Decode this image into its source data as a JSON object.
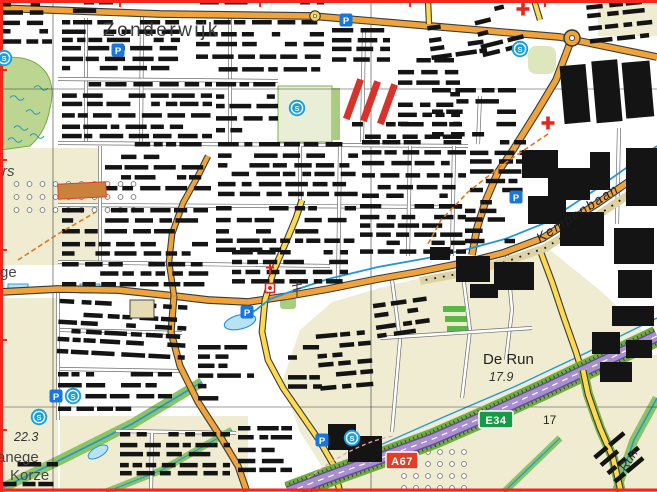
{
  "labels": {
    "town": "Zonderwijk",
    "street": "Kempenbaan",
    "area": "De Run",
    "area_elevation": "17.9",
    "elevation_sw": "22.3",
    "partial_left_top": "rs",
    "partial_left_mid": "ge",
    "partial_manege": "anege",
    "partial_korze": "Korze",
    "parcel": "17",
    "stream": "Run"
  },
  "shields": {
    "e_road": "E34",
    "a_road": "A67"
  },
  "icons": {
    "parking": "P",
    "sport": "S"
  },
  "poi": {
    "parking": [
      [
        118,
        50
      ],
      [
        346,
        20
      ],
      [
        516,
        197
      ],
      [
        247,
        312
      ],
      [
        56,
        396
      ],
      [
        322,
        440
      ]
    ],
    "sport": [
      [
        297,
        108
      ],
      [
        520,
        49
      ],
      [
        73,
        396
      ],
      [
        39,
        417
      ],
      [
        352,
        438
      ],
      [
        4,
        58
      ]
    ],
    "first_aid": [
      [
        523,
        9
      ],
      [
        548,
        123
      ]
    ],
    "church_cross": [
      [
        270,
        271
      ]
    ],
    "church": [
      [
        270,
        288
      ]
    ]
  },
  "colors": {
    "boundary": "#f5261c",
    "motorway_fill": "#a98fd0",
    "primary_road": "#f0a339",
    "secondary_road": "#ffd94e",
    "water": "#2098d8",
    "field": "#efecd2",
    "woodland": "#bcd692",
    "building": "#141414",
    "shield_e_green": "#169a43",
    "shield_a_red": "#e73b23",
    "poi_blue": "#1677e0"
  }
}
